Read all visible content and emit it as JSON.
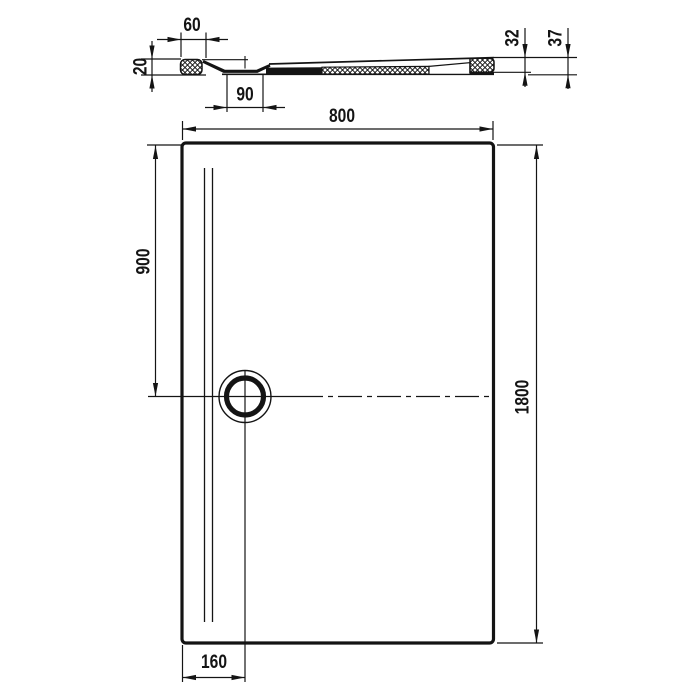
{
  "drawing": {
    "kind": "shower-tray technical drawing",
    "colors": {
      "line": "#141414",
      "background": "#ffffff"
    },
    "section_view": {
      "dimensions": {
        "rim_top_width": "60",
        "rim_height": "20",
        "drain_recess_width": "90",
        "tray_height": "32",
        "total_height": "37"
      }
    },
    "plan_view": {
      "dimensions": {
        "width": "800",
        "drain_center_from_top": "900",
        "length": "1800",
        "drain_center_from_left": "160"
      }
    }
  }
}
